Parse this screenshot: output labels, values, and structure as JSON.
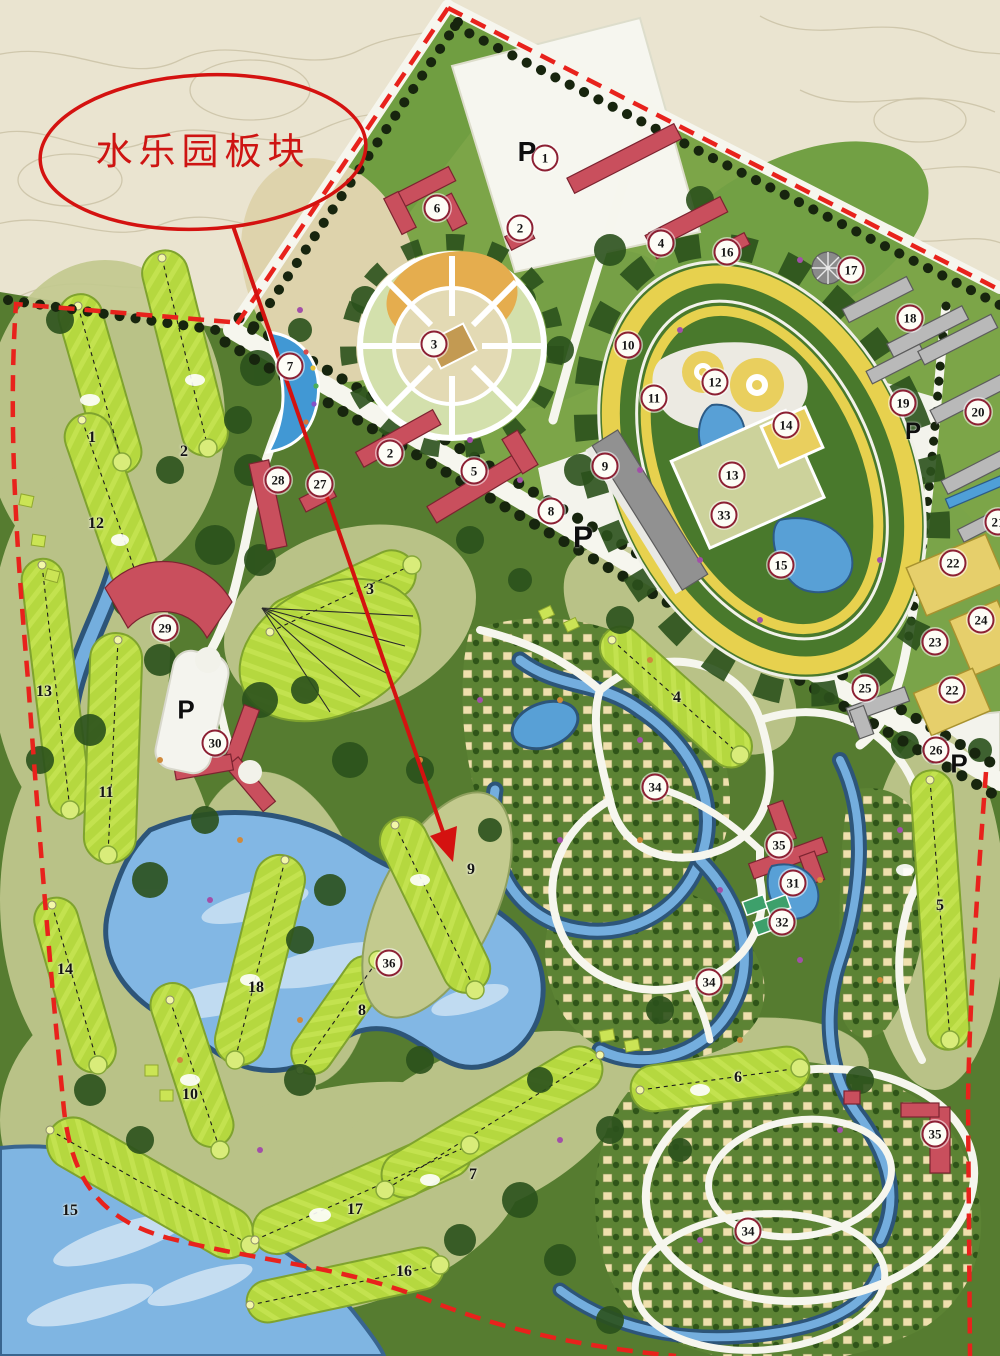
{
  "annotation": {
    "label": "水乐园板块",
    "color": "#ce1412"
  },
  "map": {
    "colors": {
      "boundary_dash": "#e8221c",
      "marker_ring": "#8c2033",
      "fairway": "#b5d83f",
      "water": "#7fb5e2",
      "racetrack": "#e7d14e",
      "building_red": "#c94f5d",
      "paper": "#eae4d0"
    },
    "circled_markers": [
      {
        "label": "1",
        "x": 545,
        "y": 158
      },
      {
        "label": "6",
        "x": 437,
        "y": 208
      },
      {
        "label": "2",
        "x": 520,
        "y": 228
      },
      {
        "label": "4",
        "x": 661,
        "y": 243
      },
      {
        "label": "16",
        "x": 727,
        "y": 252
      },
      {
        "label": "17",
        "x": 851,
        "y": 270
      },
      {
        "label": "18",
        "x": 910,
        "y": 318
      },
      {
        "label": "10",
        "x": 628,
        "y": 345
      },
      {
        "label": "3",
        "x": 434,
        "y": 344
      },
      {
        "label": "7",
        "x": 290,
        "y": 366
      },
      {
        "label": "12",
        "x": 715,
        "y": 382
      },
      {
        "label": "11",
        "x": 654,
        "y": 398
      },
      {
        "label": "19",
        "x": 903,
        "y": 403
      },
      {
        "label": "20",
        "x": 978,
        "y": 412
      },
      {
        "label": "14",
        "x": 786,
        "y": 425
      },
      {
        "label": "2",
        "x": 390,
        "y": 453
      },
      {
        "label": "9",
        "x": 605,
        "y": 466
      },
      {
        "label": "5",
        "x": 474,
        "y": 471
      },
      {
        "label": "13",
        "x": 732,
        "y": 475
      },
      {
        "label": "28",
        "x": 278,
        "y": 480
      },
      {
        "label": "27",
        "x": 320,
        "y": 484
      },
      {
        "label": "8",
        "x": 551,
        "y": 511
      },
      {
        "label": "33",
        "x": 724,
        "y": 515
      },
      {
        "label": "21",
        "x": 998,
        "y": 522
      },
      {
        "label": "22",
        "x": 953,
        "y": 563
      },
      {
        "label": "15",
        "x": 781,
        "y": 565
      },
      {
        "label": "24",
        "x": 981,
        "y": 620
      },
      {
        "label": "29",
        "x": 165,
        "y": 628
      },
      {
        "label": "23",
        "x": 935,
        "y": 642
      },
      {
        "label": "25",
        "x": 865,
        "y": 688
      },
      {
        "label": "22",
        "x": 952,
        "y": 690
      },
      {
        "label": "30",
        "x": 215,
        "y": 743
      },
      {
        "label": "26",
        "x": 936,
        "y": 750
      },
      {
        "label": "34",
        "x": 655,
        "y": 787
      },
      {
        "label": "35",
        "x": 779,
        "y": 845
      },
      {
        "label": "31",
        "x": 793,
        "y": 883
      },
      {
        "label": "32",
        "x": 782,
        "y": 922
      },
      {
        "label": "36",
        "x": 389,
        "y": 963
      },
      {
        "label": "34",
        "x": 709,
        "y": 982
      },
      {
        "label": "35",
        "x": 935,
        "y": 1134
      },
      {
        "label": "34",
        "x": 748,
        "y": 1231
      }
    ],
    "golf_hole_numbers": [
      {
        "label": "1",
        "x": 92,
        "y": 438
      },
      {
        "label": "2",
        "x": 184,
        "y": 452
      },
      {
        "label": "12",
        "x": 96,
        "y": 524
      },
      {
        "label": "3",
        "x": 370,
        "y": 590
      },
      {
        "label": "13",
        "x": 44,
        "y": 692
      },
      {
        "label": "4",
        "x": 677,
        "y": 698
      },
      {
        "label": "11",
        "x": 106,
        "y": 793
      },
      {
        "label": "9",
        "x": 471,
        "y": 870
      },
      {
        "label": "5",
        "x": 940,
        "y": 906
      },
      {
        "label": "14",
        "x": 65,
        "y": 970
      },
      {
        "label": "18",
        "x": 256,
        "y": 988
      },
      {
        "label": "8",
        "x": 362,
        "y": 1011
      },
      {
        "label": "10",
        "x": 190,
        "y": 1095
      },
      {
        "label": "6",
        "x": 738,
        "y": 1078
      },
      {
        "label": "15",
        "x": 70,
        "y": 1211
      },
      {
        "label": "17",
        "x": 355,
        "y": 1210
      },
      {
        "label": "7",
        "x": 473,
        "y": 1175
      },
      {
        "label": "16",
        "x": 404,
        "y": 1272
      }
    ],
    "parking_labels": [
      {
        "label": "P",
        "x": 527,
        "y": 152,
        "size": 28
      },
      {
        "label": "P",
        "x": 913,
        "y": 432,
        "size": 24
      },
      {
        "label": "P",
        "x": 583,
        "y": 538,
        "size": 30
      },
      {
        "label": "P",
        "x": 186,
        "y": 710,
        "size": 26
      },
      {
        "label": "P",
        "x": 959,
        "y": 764,
        "size": 26
      }
    ]
  }
}
